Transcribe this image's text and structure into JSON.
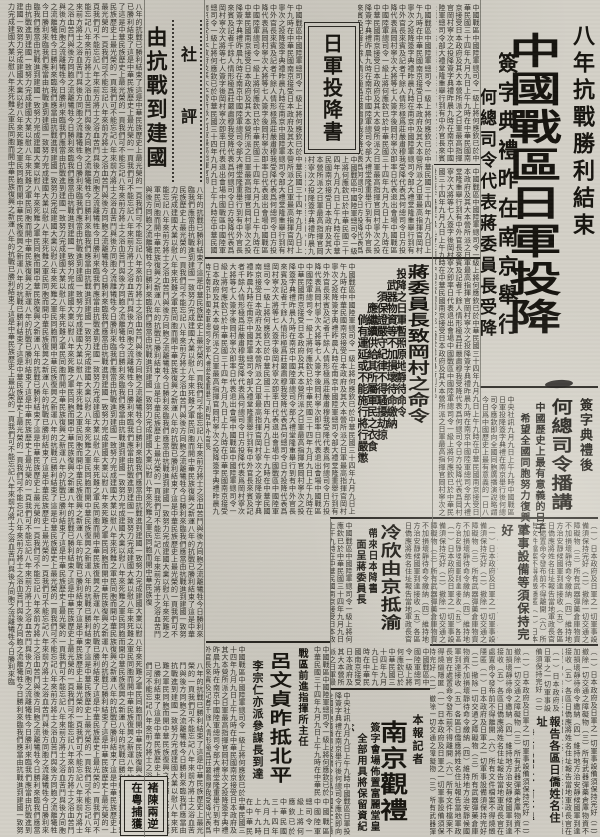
{
  "page": {
    "background": "#d3d0c7",
    "ink": "#26241f"
  },
  "masthead": {
    "banner": "八年抗戰勝利結束",
    "headline": "中國戰區日軍投降",
    "deck1": "簽字典禮昨在南京舉行",
    "deck2": "何總司令代表蔣委員長受降"
  },
  "broadcast": {
    "kicker": "簽字典禮後",
    "headline": "何總司令播講",
    "decks": "中國歷史上最有意義的日子\n　希望全國同胞努力復興大業"
  },
  "surrender_box": {
    "title": "日軍投降書"
  },
  "editorial": {
    "label": "社評",
    "headline": "由抗戰到建國"
  },
  "chiang_order": {
    "headline": "蔣委員長致岡村之命令",
    "decks": "投降之日軍暫照原地靜待命令\n　武器物資等不加損壞待命繳納\n　　須保證嚴守紀律不得騷擾劫掠\n　　　應繼續供給其所屬軍民之衣食\n　　　　倘有運延或不能施行將行嚴懲"
  },
  "order_more": {
    "decks": "軍事設備等須保持完好\n　撤除一切交通之障礙物"
  },
  "lengxin": {
    "headline": "冷欣由京抵渝",
    "decks": "帶來日本降書\n　面呈蔣委員長"
  },
  "lyu": {
    "kicker": "戰區前進指揮所主任",
    "headline": "呂文貞昨抵北平",
    "deck": "李宗仁亦派參謀長到達"
  },
  "ceremony": {
    "kicker": "本報記者",
    "headline": "南京觀禮",
    "decks": "簽字會場佈置富麗堂皇\n　全部用具將保留資紀念"
  },
  "overseas": {
    "decks": "報告各區日僑姓名住址\n　發布處置令前不得離開"
  },
  "capture_box": {
    "text": "褚陳兩逆\n在粵捕獲"
  },
  "filler": {
    "body": "中國戰區中國陸軍總司令一級上將何應欽已於中華民國三十四年九月九日上午九時在中華民國南京接受日本政府及其大本營所派之日軍最高指揮官岡村寧次之投降簽字典禮昨晨九時在南京中國陸軍總司令部大禮堂隆重舉行到有中外官長來賓及記者千餘人情形極爲莊嚴肅穆我受降代表爲何總司令日方投降代表爲岡村寧次大將等七人簽字後岡村寧次即率日代表退出會場",
    "editorial": "八年的抗戰已勝利結束了這是中華民族歷史上最光榮的一頁我們可不能忘記八年來前方將士之浴血苦鬥與後方同胞之流離犧牲今日勝利來臨我們應當由抗戰進到建國一致努力完成建國大業以慰八年來死難之軍民同胞而開中華民族復興之新運",
    "items": "（一）日本政府及日軍之一切軍事設備須保持完好（二）撤除一切交通之障礙物（三）所有武器彈藥倉庫物資不加損壞靜待命令繳納（四）維持地方治安靜候國軍到達接收（五）各區日僑應將姓名住址報告當地軍政長官在處置命令發布前不得離開（六）所有文件檔案不得燒燬隱匿",
    "broadcast": "中央社訊九月九日上午九時中國戰區日軍投降簽字典禮在南京舉行後何總司令應欽即向全國同胞廣播演說略謂今日爲中國歷史上最有意義的一日八年抗戰艱苦奮鬥卒獲最後勝利敵軍百萬已在南京正式簽字投降此實爲我中華民族復興之起點深望全國同胞今後一致努力於復興建設之大業云"
  }
}
